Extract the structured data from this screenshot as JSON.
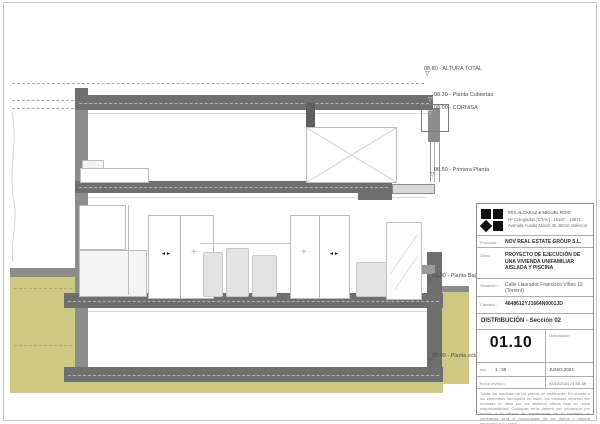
{
  "levels": [
    {
      "text": "08.80 - ALTURA TOTAL"
    },
    {
      "text": "08.30 - Planta Cubiertas"
    },
    {
      "text": "08.00 - CORNISA"
    },
    {
      "text": "06.50 - Primera Planta"
    },
    {
      "text": "03.00 - Planta Baja"
    },
    {
      "text": "00.00 - Planta sótano"
    }
  ],
  "icons": {
    "level_flag": "▽",
    "sliding_arrows": "◄►",
    "fixed_cross": "+"
  },
  "title_block": {
    "architect": {
      "line1": "IRIS ALCARAZ & MIGUEL ROIG",
      "line2": "Nº Colegiados [CTAV] : 15167 - 13871",
      "line3": "Avenida Ausiàs March 35 46010 València"
    },
    "promotor_label": "Promotor :",
    "promotor": "NOV REAL ESTATE GROUP S.L.",
    "obra_label": "Obra :",
    "obra": "PROYECTO DE EJECUCIÓN DE UNA VIVIENDA UNIFAMILIAR AISLADA Y PISCINA",
    "situacion_label": "Situación :",
    "situacion": "Calle Llaurador Francisco Viñes 12 (Torrent)",
    "catastro_label": "Catastro :",
    "catastro": "4648612YJ1664N0001JD",
    "drawing_title": "DISTRIBUCIÓN - Sección 02",
    "sheet_number": "01.10",
    "orientation_label": "Orientación",
    "scale_label": "esc :",
    "scale_value": "1 : 50",
    "date": "JUNIO 2024",
    "revision_label": "fecha revisión",
    "revision_value": "02/10/2024 21:05:38",
    "disclaimer": "Todas las medidas de los planos se verificarán. En cuanto a los elementos fabricados en taller, las medidas deberán ser tomadas en obra por los distintos oficios bajo su única responsabilidad. Cualquier error deberá ser informado por escrito a la oficina de arquitectura; de lo contrario, el contratista será el responsable de los daños y deberá repararlos a su costa."
  },
  "colors": {
    "slab_gray": "#6f6f6f",
    "wall_gray": "#8c8c8c",
    "terrain_olive": "#cdc983",
    "logo_black": "#111111"
  }
}
